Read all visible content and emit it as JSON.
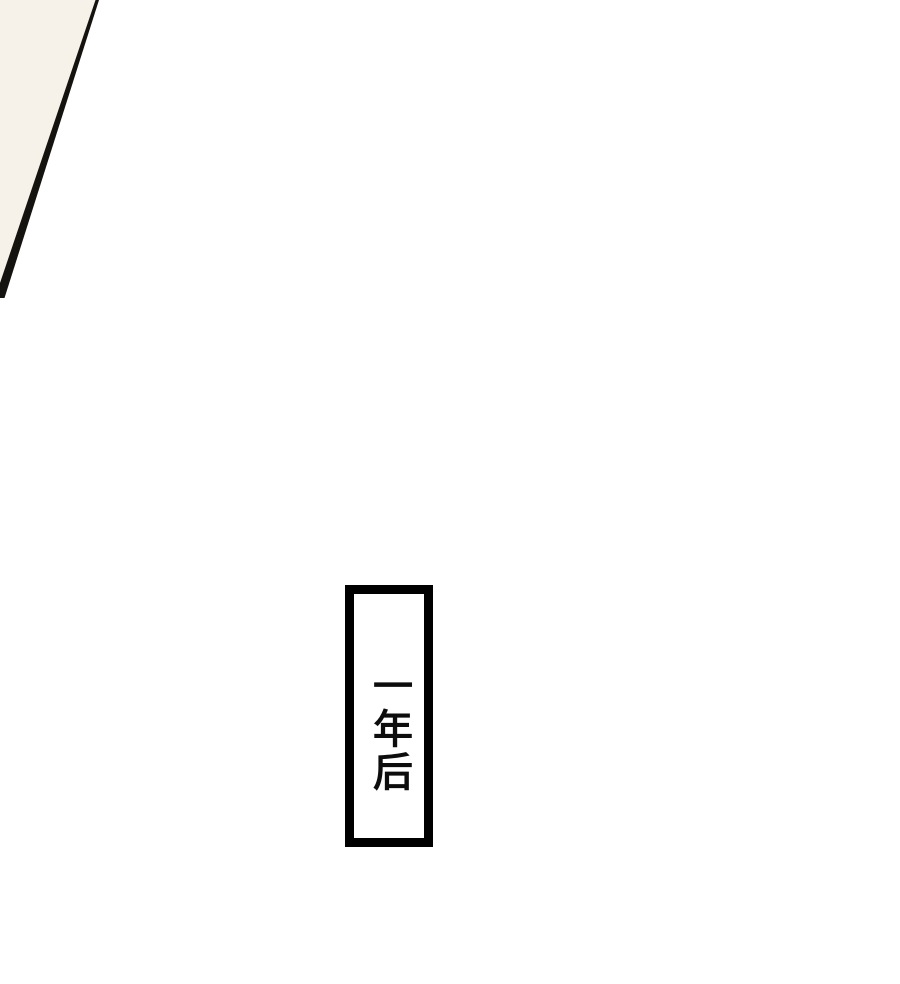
{
  "page": {
    "background_color": "#ffffff",
    "corner_panel": {
      "fill_color": "#f6f1e9",
      "line_color": "#15130f"
    },
    "caption_box": {
      "text": "一年后",
      "border_color": "#000000",
      "background_color": "#ffffff",
      "text_color": "#0d0d0d"
    }
  }
}
